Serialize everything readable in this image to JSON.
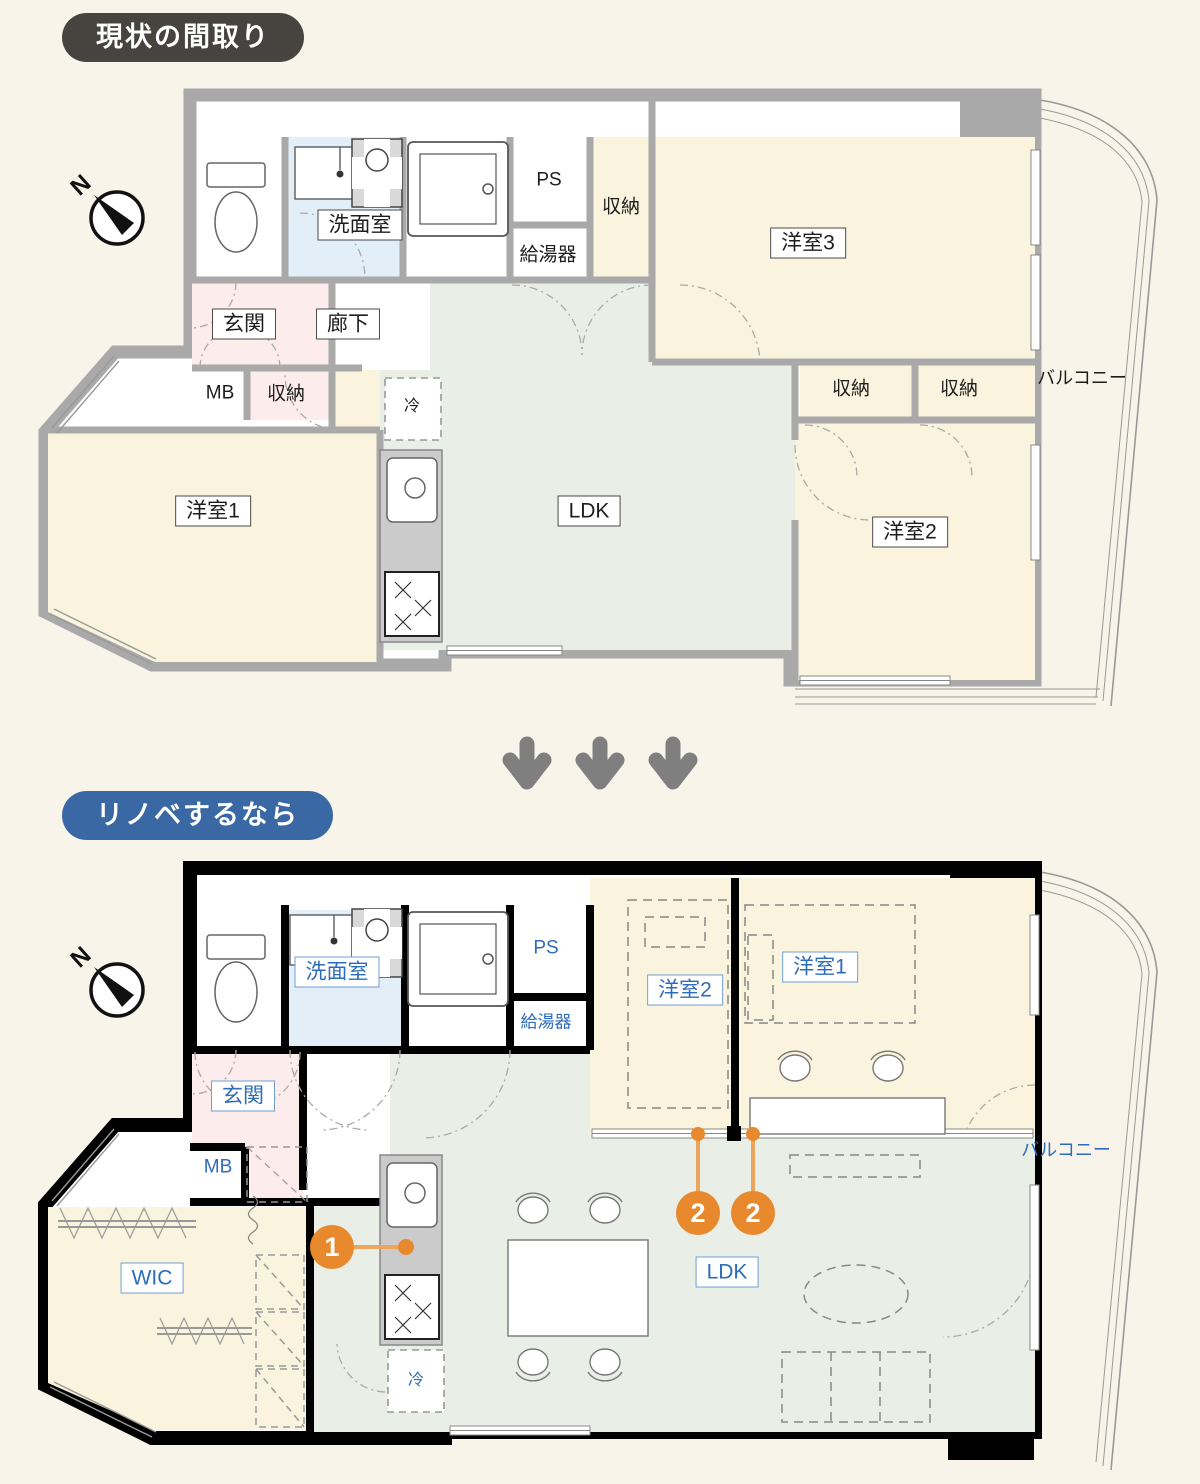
{
  "badges": {
    "current": "現状の間取り",
    "renovated": "リノベするなら"
  },
  "compass": {
    "north": "N"
  },
  "plan_current": {
    "rooms": {
      "washroom": "洗面室",
      "ps": "PS",
      "water_heater": "給湯器",
      "closet_top": "収納",
      "bedroom3": "洋室3",
      "entrance": "玄関",
      "hallway": "廊下",
      "meter_box": "MB",
      "closet_entrance": "収納",
      "closet_left": "収納",
      "closet_right": "収納",
      "fridge": "冷",
      "bedroom1": "洋室1",
      "ldk": "LDK",
      "bedroom2": "洋室2",
      "balcony": "バルコニー"
    }
  },
  "plan_renovated": {
    "rooms": {
      "washroom": "洗面室",
      "ps": "PS",
      "water_heater": "給湯器",
      "bedroom2": "洋室2",
      "bedroom1": "洋室1",
      "entrance": "玄関",
      "meter_box": "MB",
      "wic": "WIC",
      "ldk": "LDK",
      "fridge": "冷",
      "balcony": "バルコニー"
    },
    "markers": {
      "kitchen": "1",
      "partition_left": "2",
      "partition_right": "2"
    }
  },
  "colors": {
    "badge_current": "#474440",
    "badge_renovated": "#3a68a4",
    "marker_orange": "#e8892d",
    "wall_current": "#a9a9a9",
    "wall_renovated": "#000000",
    "room_cream": "#faf3dd",
    "ldk_green": "#e9efe6",
    "washroom_blue": "#e2eff8",
    "entrance_pink": "#fcecec",
    "label_blue": "#2d6cb9"
  }
}
